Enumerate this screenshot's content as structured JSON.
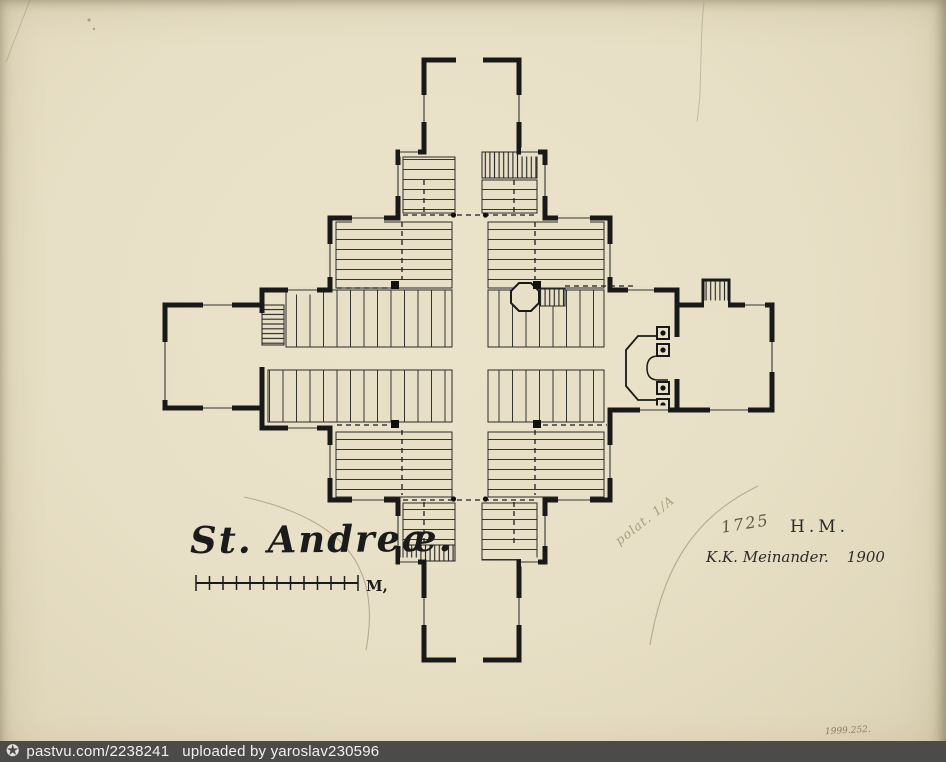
{
  "colors": {
    "paper": "#e8e0c6",
    "ink": "#1a1a1a",
    "pencil": "#988b6a",
    "footer_background": "#4b4b4a",
    "footer_text": "#f0f0f0"
  },
  "drawing": {
    "title": "St. Andreæ.",
    "scale_unit_label": "M,",
    "year_pencil": "1725",
    "initials": "H.M.",
    "signature_name": "K.K. Meinander.",
    "signature_year": "1900",
    "pencil_note": "polat. 1/A",
    "inventory_number": "1999.252."
  },
  "footer": {
    "icon_name": "circled-star-icon",
    "icon_glyph": "✪",
    "source": "pastvu.com/2238241",
    "uploaded_by": "uploaded by yaroslav230596"
  }
}
